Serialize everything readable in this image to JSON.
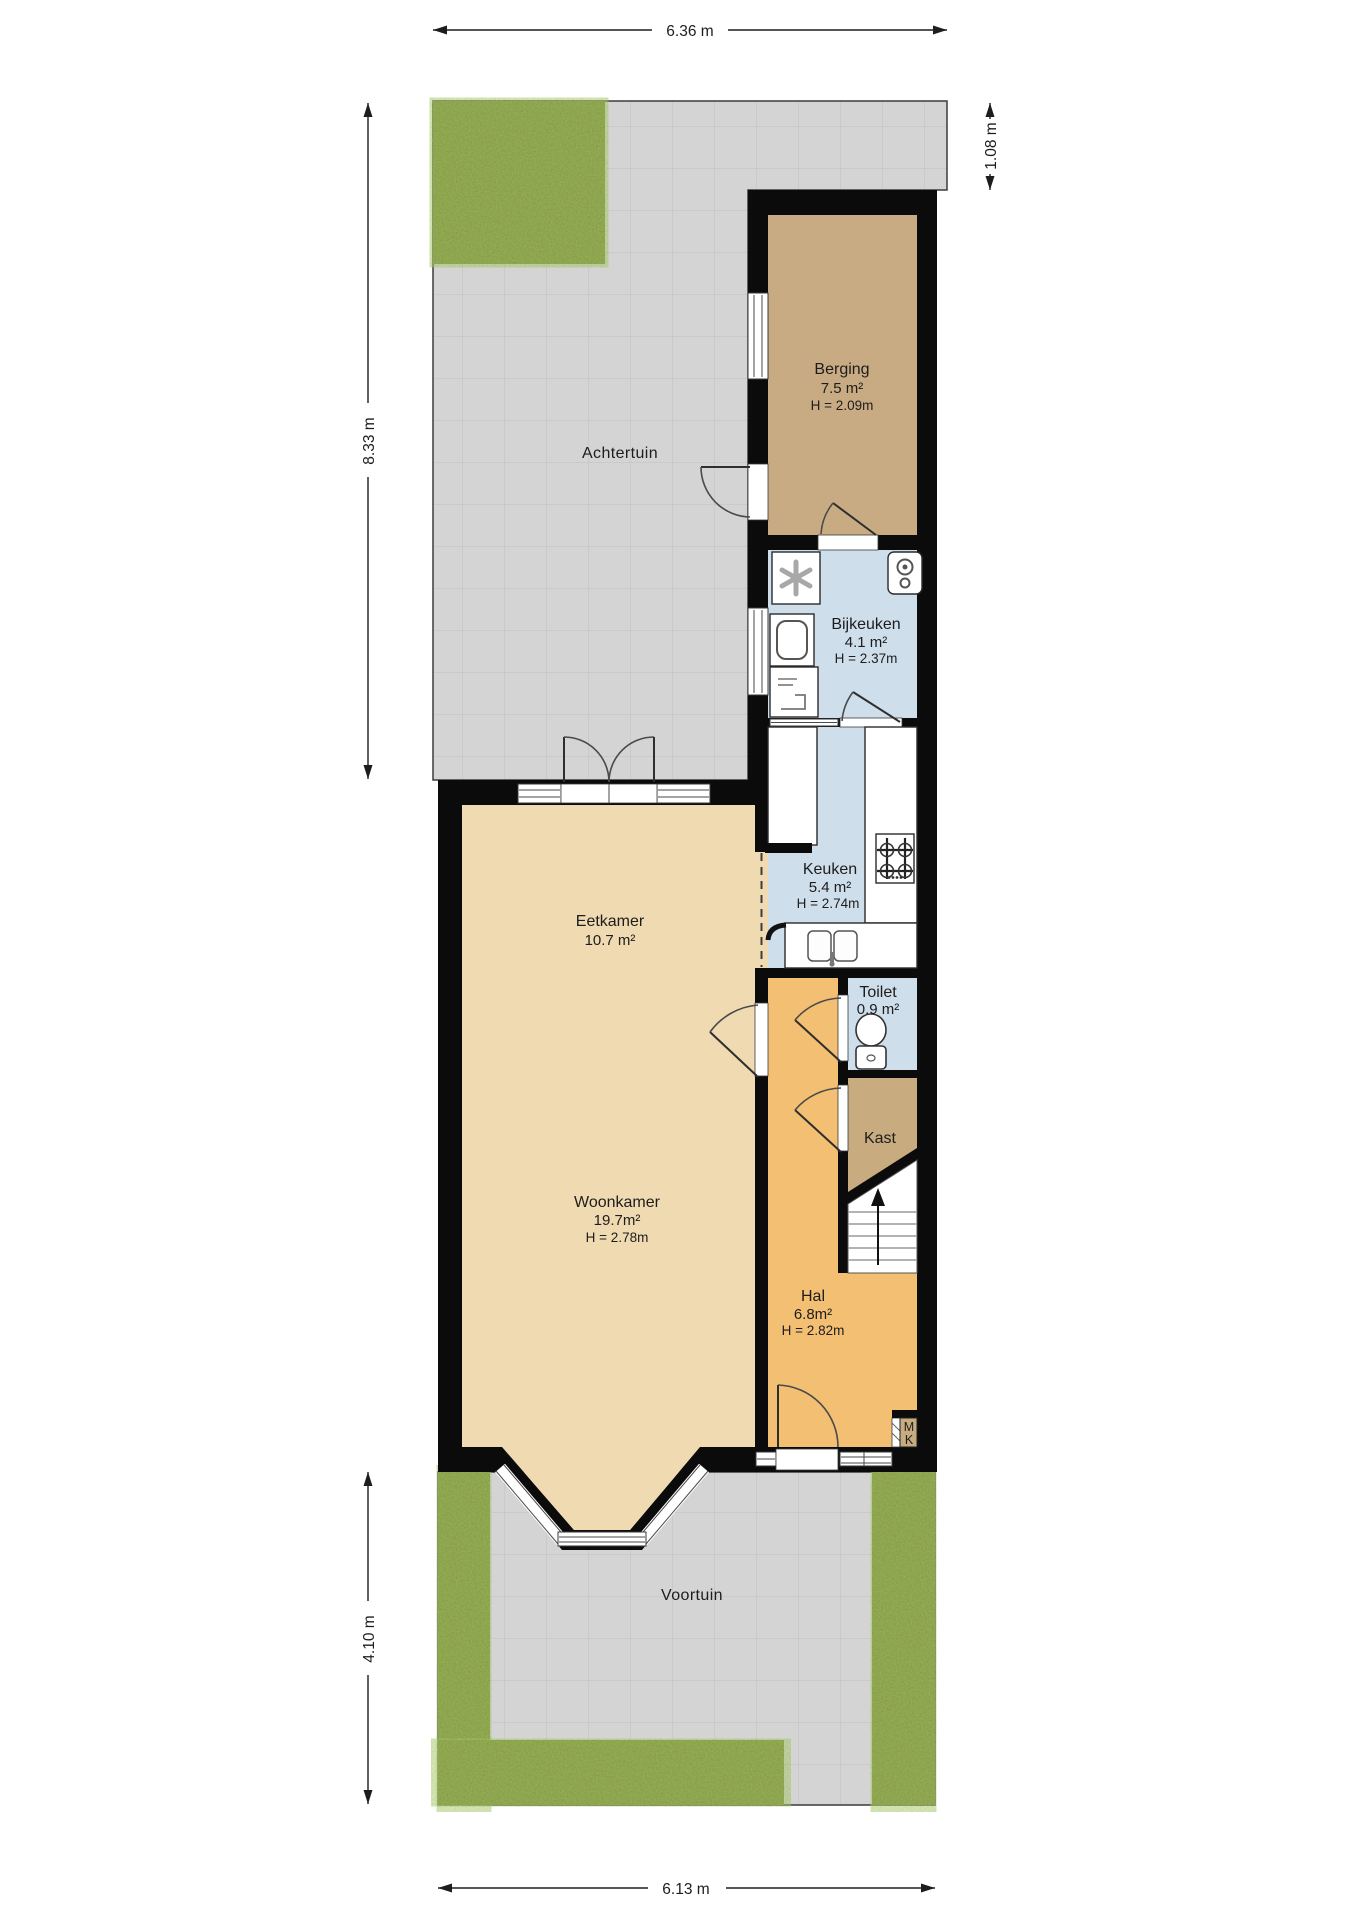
{
  "dimensions": {
    "top": "6.36 m",
    "extension": "1.08 m",
    "back": "8.33 m",
    "front": "4.10 m",
    "bottom": "6.13 m"
  },
  "gardens": {
    "back": "Achtertuin",
    "front": "Voortuin"
  },
  "rooms": {
    "berging": {
      "name": "Berging",
      "area": "7.5 m²",
      "height": "H = 2.09m"
    },
    "bijkeuken": {
      "name": "Bijkeuken",
      "area": "4.1 m²",
      "height": "H = 2.37m"
    },
    "keuken": {
      "name": "Keuken",
      "area": "5.4 m²",
      "height": "H = 2.74m"
    },
    "eetkamer": {
      "name": "Eetkamer",
      "area": "10.7 m²"
    },
    "woonkamer": {
      "name": "Woonkamer",
      "area": "19.7m²",
      "height": "H = 2.78m"
    },
    "toilet": {
      "name": "Toilet",
      "area": "0.9 m²"
    },
    "kast": {
      "name": "Kast"
    },
    "hal": {
      "name": "Hal",
      "area": "6.8m²",
      "height": "H = 2.82m"
    },
    "meterkast": {
      "line1": "M",
      "line2": "K"
    }
  },
  "icons": [
    "washing-machine-icon",
    "boiler-icon",
    "dryer-icon",
    "dishwasher-icon",
    "fridge-unit",
    "gas-hob-icon",
    "kitchen-sink-icon",
    "toilet-icon",
    "stairs-up-arrow-icon"
  ],
  "colors": {
    "wall": "#0b0b0b",
    "paving": "#d4d4d4",
    "grass": "#7b883d",
    "storage_tan": "#c8ab83",
    "closet_tan": "#c8ab7e",
    "utility_blue": "#cfdeeb",
    "living_tan": "#f0dab1",
    "hall_orange": "#f3bf72"
  }
}
